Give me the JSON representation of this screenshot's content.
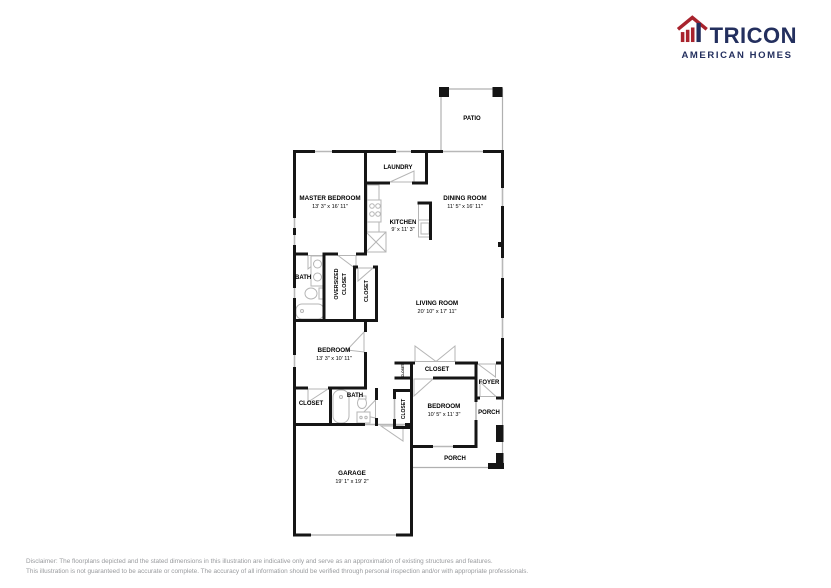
{
  "logo": {
    "brand": "TRICON",
    "tagline": "AMERICAN HOMES",
    "colors": {
      "red": "#a8232d",
      "navy": "#232f5e"
    }
  },
  "floorplan": {
    "wall_color": "#151515",
    "fixture_color": "#b5b5b5",
    "rooms": {
      "patio": {
        "label": "PATIO"
      },
      "laundry": {
        "label": "LAUNDRY"
      },
      "master_bedroom": {
        "label": "MASTER BEDROOM",
        "dims": "13' 3\" x 16' 11\""
      },
      "dining_room": {
        "label": "DINING ROOM",
        "dims": "11' 5\" x 16' 11\""
      },
      "kitchen": {
        "label": "KITCHEN",
        "dims": "9' x 11' 3\""
      },
      "master_bath": {
        "label": "BATH"
      },
      "oversized_closet": {
        "line1": "OVERSIZED",
        "line2": "CLOSET"
      },
      "master_closet": {
        "label": "CLOSET"
      },
      "living_room": {
        "label": "LIVING ROOM",
        "dims": "20' 10\" x 17' 11\""
      },
      "bedroom_2": {
        "label": "BEDROOM",
        "dims": "13' 3\" x 10' 11\""
      },
      "bedroom_2_closet": {
        "label": "CLOSET"
      },
      "bath_2": {
        "label": "BATH"
      },
      "hall_closet": {
        "label": "CLOSET"
      },
      "entry_closet_small": {
        "label": "CLOSET"
      },
      "bedroom_3_closet": {
        "label": "CLOSET"
      },
      "bedroom_3": {
        "label": "BEDROOM",
        "dims": "10' 5\" x 11' 3\""
      },
      "foyer": {
        "label": "FOYER"
      },
      "porch_side": {
        "label": "PORCH"
      },
      "porch_front": {
        "label": "PORCH"
      },
      "garage": {
        "label": "GARAGE",
        "dims": "19' 1\" x 19' 2\""
      }
    }
  },
  "disclaimer": {
    "line1": "Disclaimer:  The floorplans depicted and the stated dimensions in this illustration are indicative only and serve as an approximation of existing structures and features.",
    "line2": "This illustration is not guaranteed to be accurate or complete.  The accuracy of all information should be verified through personal inspection and/or with appropriate professionals."
  }
}
